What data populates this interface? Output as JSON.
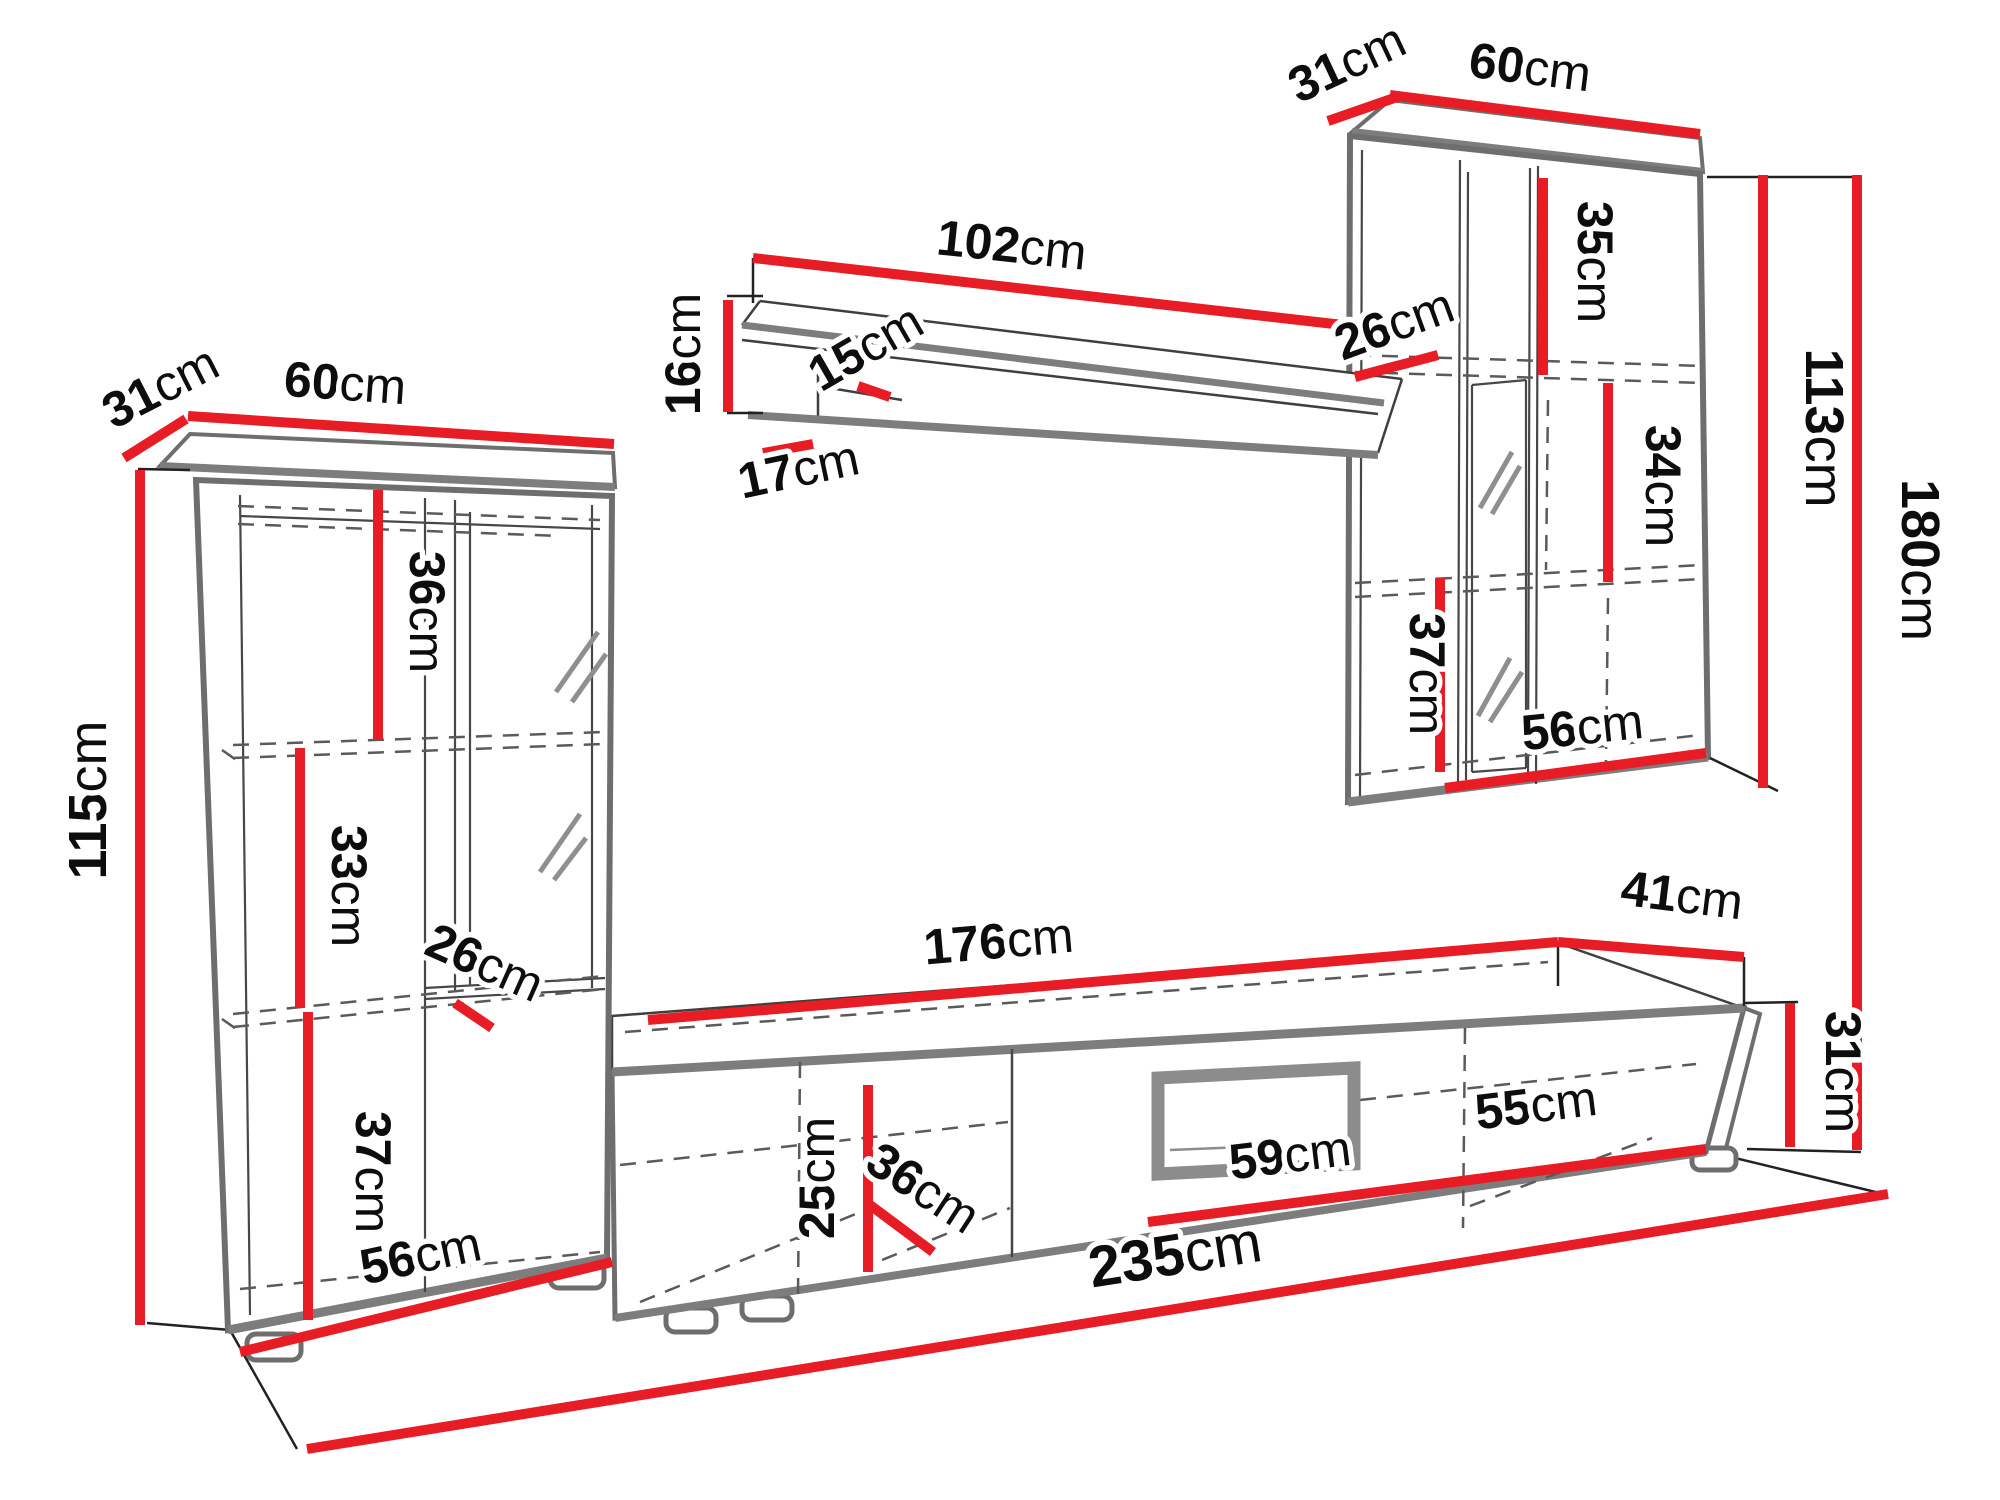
{
  "unit": "cm",
  "dimensions": {
    "left_cabinet": {
      "depth": "31",
      "width": "60",
      "height": "115",
      "upper_section_height": "36",
      "middle_section_height": "33",
      "shelf_depth": "26",
      "lower_section_height": "37",
      "interior_width": "56"
    },
    "wall_shelf": {
      "length": "102",
      "height": "16",
      "top_depth": "15",
      "bottom_depth": "17"
    },
    "right_cabinet": {
      "depth": "31",
      "width": "60",
      "upper_section_height": "35",
      "shelf_depth": "26",
      "middle_section_height": "34",
      "height": "113",
      "lower_section_height": "37",
      "interior_width": "56"
    },
    "tv_stand": {
      "length": "176",
      "depth": "41",
      "height": "31",
      "front_height": "25",
      "interior_depth": "36",
      "niche_width": "59",
      "right_section_width": "55"
    },
    "total": {
      "height": "180",
      "width": "235"
    }
  },
  "colors": {
    "dimension_line": "#e81c24",
    "outline_thick": "#7d7d7d",
    "outline_thin": "#3f3f3f",
    "dashed": "#5a5a5a",
    "text": "#0d0d0d"
  }
}
